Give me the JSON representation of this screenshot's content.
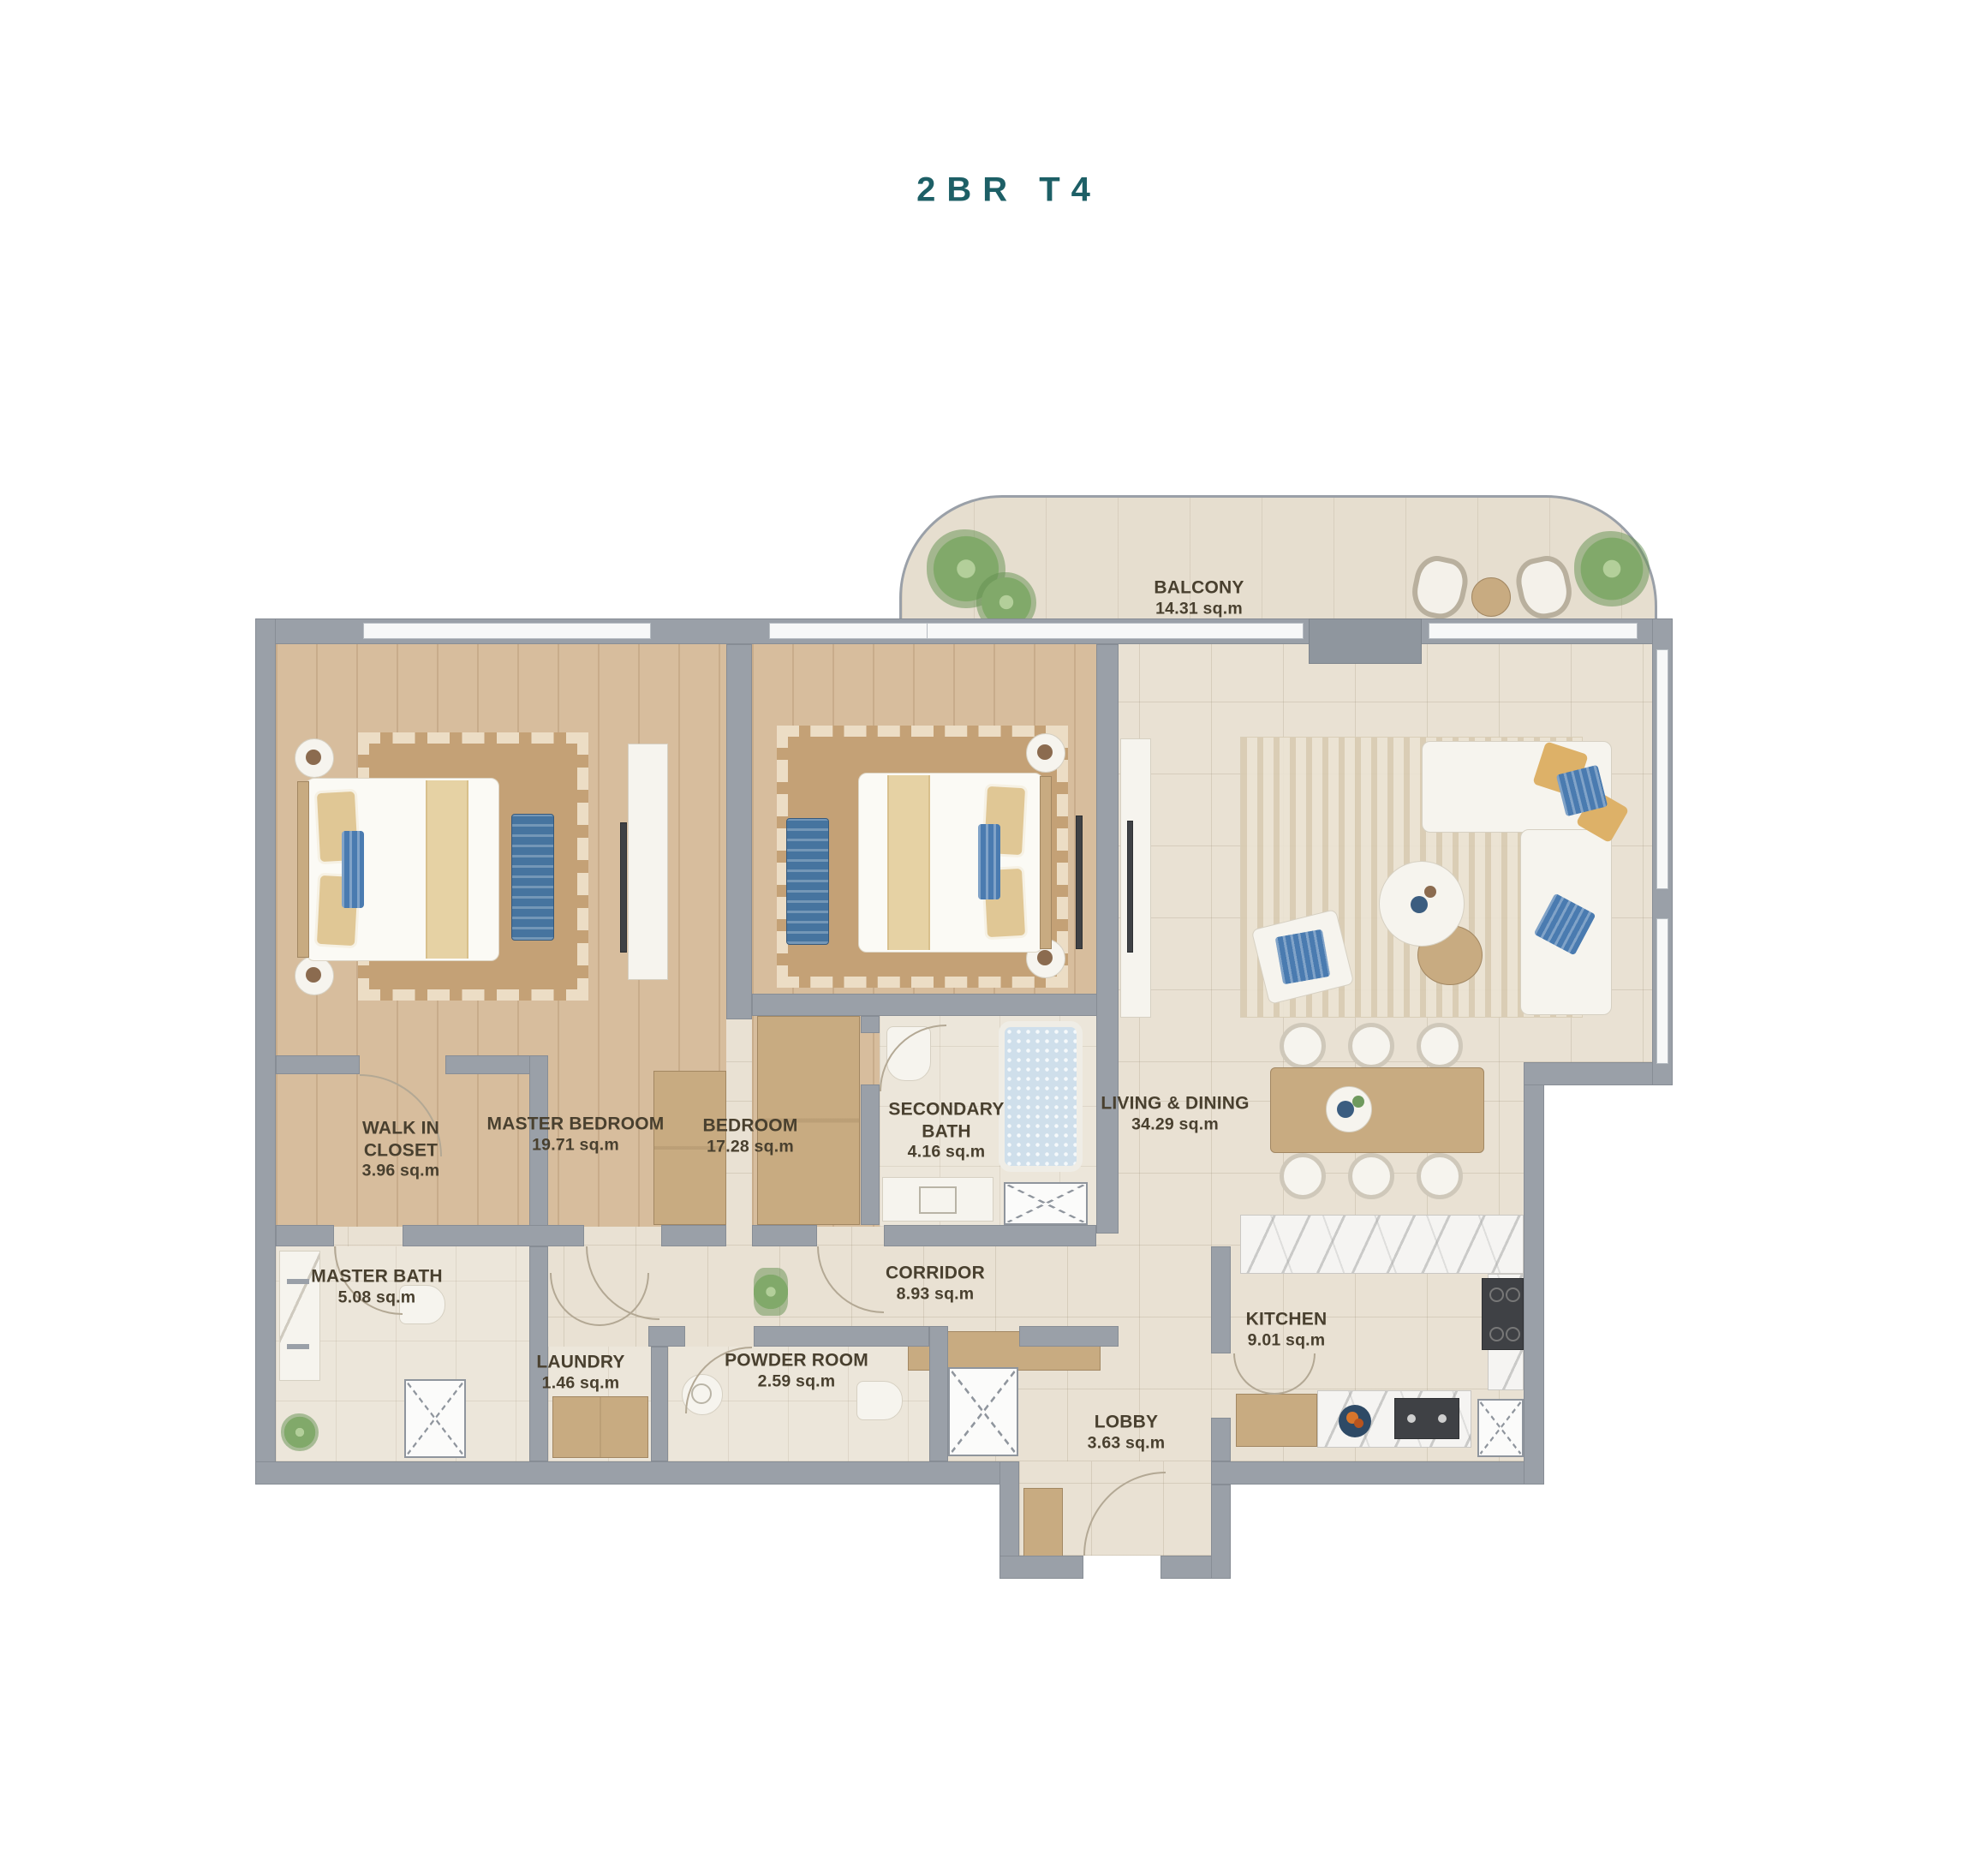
{
  "title": "2BR T4",
  "accent_color": "#1d5f66",
  "label_color": "#49402f",
  "wall_color": "#9aa0a8",
  "rooms": {
    "balcony": {
      "name": "BALCONY",
      "area": "14.31 sq.m"
    },
    "master_bedroom": {
      "name": "MASTER BEDROOM",
      "area": "19.71 sq.m"
    },
    "walk_in_closet": {
      "name": "WALK IN CLOSET",
      "area": "3.96 sq.m"
    },
    "bedroom": {
      "name": "BEDROOM",
      "area": "17.28 sq.m"
    },
    "secondary_bath": {
      "name": "SECONDARY BATH",
      "area": "4.16 sq.m"
    },
    "living_dining": {
      "name": "LIVING & DINING",
      "area": "34.29 sq.m"
    },
    "master_bath": {
      "name": "MASTER BATH",
      "area": "5.08 sq.m"
    },
    "corridor": {
      "name": "CORRIDOR",
      "area": "8.93 sq.m"
    },
    "laundry": {
      "name": "LAUNDRY",
      "area": "1.46 sq.m"
    },
    "powder_room": {
      "name": "POWDER ROOM",
      "area": "2.59 sq.m"
    },
    "kitchen": {
      "name": "KITCHEN",
      "area": "9.01 sq.m"
    },
    "lobby": {
      "name": "LOBBY",
      "area": "3.63 sq.m"
    }
  }
}
